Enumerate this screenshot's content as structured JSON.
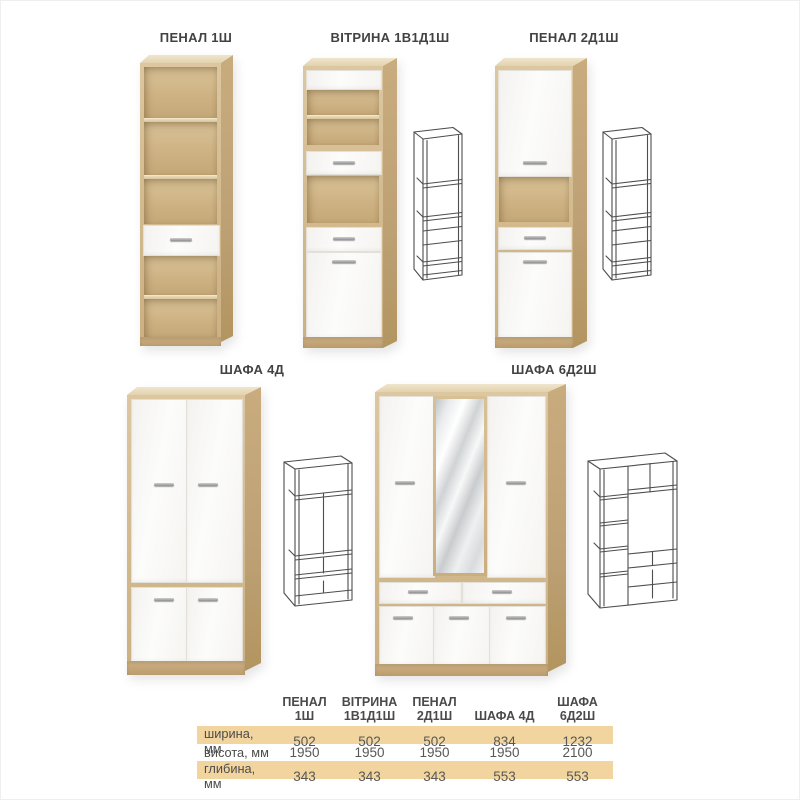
{
  "colors": {
    "oak_front": "#d2b98e",
    "oak_side": "#bda074",
    "white_front": "#fbfbfa",
    "mirror_gray": "#d0d3d5",
    "table_band": "#f2d59e",
    "text": "#4a4a4a",
    "wireframe_stroke": "#4d4d4d"
  },
  "products": [
    {
      "label": "ПЕНАЛ 1Ш"
    },
    {
      "label": "ВІТРИНА 1В1Д1Ш"
    },
    {
      "label": "ПЕНАЛ 2Д1Ш"
    },
    {
      "label": "ШАФА 4Д"
    },
    {
      "label": "ШАФА 6Д2Ш"
    }
  ],
  "spec_table": {
    "column_headers": [
      "ПЕНАЛ\n1Ш",
      "ВІТРИНА\n1В1Д1Ш",
      "ПЕНАЛ\n2Д1Ш",
      "ШАФА 4Д",
      "ШАФА\n6Д2Ш"
    ],
    "rows": [
      {
        "label": "ширина, мм",
        "values": [
          "502",
          "502",
          "502",
          "834",
          "1232"
        ],
        "shaded": true
      },
      {
        "label": "висота, мм",
        "values": [
          "1950",
          "1950",
          "1950",
          "1950",
          "2100"
        ],
        "shaded": false
      },
      {
        "label": "глибина, мм",
        "values": [
          "343",
          "343",
          "343",
          "553",
          "553"
        ],
        "shaded": true
      }
    ]
  }
}
